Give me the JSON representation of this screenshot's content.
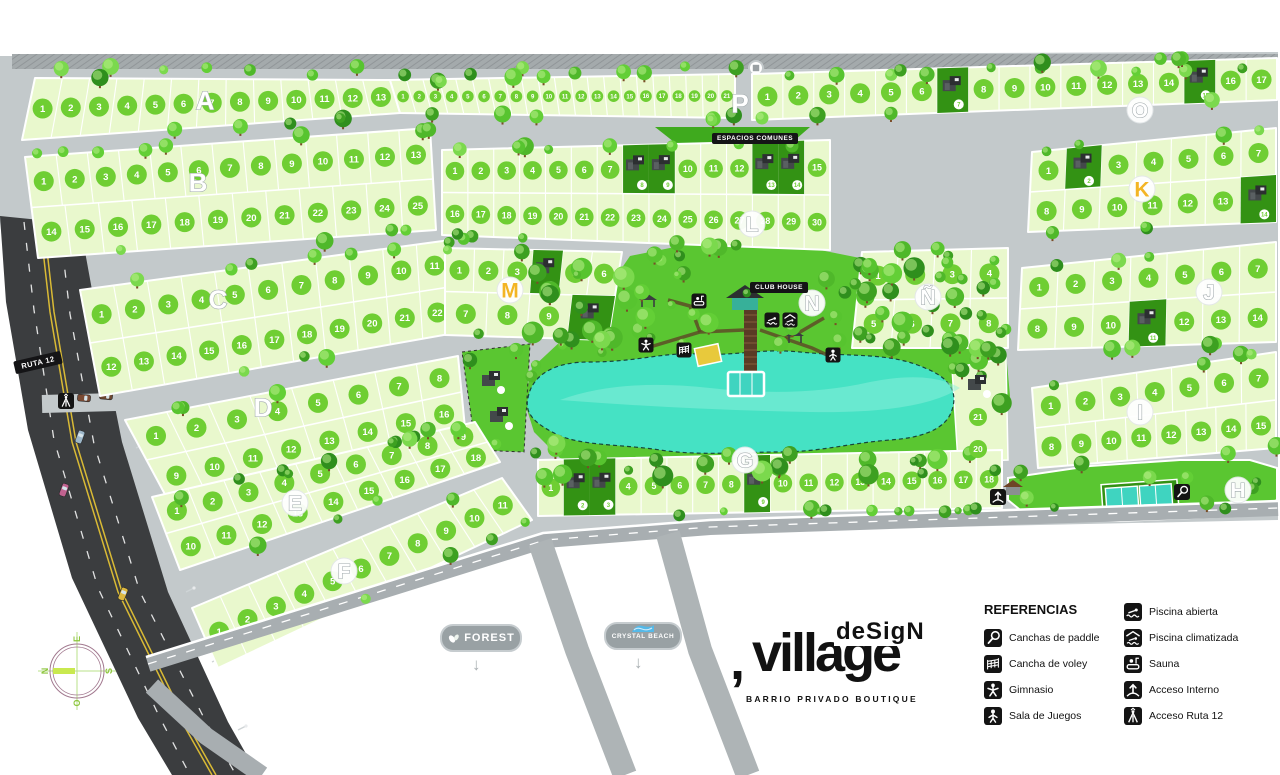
{
  "branding": {
    "logo_comma": ",",
    "logo_main": "village",
    "logo_overlay": "deSigN",
    "logo_subtitle": "BARRIO PRIVADO BOUTIQUE"
  },
  "labels": {
    "club_house": "CLUB HOUSE",
    "espacios_comunes": "ESPACIOS COMUNES",
    "ruta": "RUTA 12"
  },
  "badges": [
    {
      "id": "forest",
      "label": "FOREST",
      "icon": "leaf-icon"
    },
    {
      "id": "crystal-beach",
      "label": "CRYSTAL BEACH",
      "icon": "water-icon"
    }
  ],
  "compass": {
    "north": "N",
    "south": "S",
    "east": "E",
    "west": "O"
  },
  "legend": {
    "title": "REFERENCIAS",
    "columns": [
      [
        {
          "icon": "paddle-icon",
          "label": "Canchas de paddle"
        },
        {
          "icon": "voley-icon",
          "label": "Cancha de voley"
        },
        {
          "icon": "gym-icon",
          "label": "Gimnasio"
        },
        {
          "icon": "games-icon",
          "label": "Sala de Juegos"
        }
      ],
      [
        {
          "icon": "open-pool-icon",
          "label": "Piscina abierta"
        },
        {
          "icon": "heated-pool-icon",
          "label": "Piscina climatizada"
        },
        {
          "icon": "sauna-icon",
          "label": "Sauna"
        },
        {
          "icon": "internal-access-icon",
          "label": "Acceso Interno"
        },
        {
          "icon": "route12-access-icon",
          "label": "Acceso Ruta 12"
        }
      ]
    ]
  },
  "colors": {
    "lot": "#e9f8cd",
    "lot_badge": "#6fce33",
    "badge_text": "#ffffff",
    "model_lot": "#339214",
    "park": "#5ac631",
    "median": "#3faa1e",
    "lake": "#45e2c4",
    "lake_light": "#8ef0db",
    "road_light": "#c3c9cb",
    "road_mid": "#a8aeb1",
    "branch_road": "#aeb4b6",
    "highway": "#3b3d3f",
    "hatch": "#a4aaac",
    "hatch_line": "#84898c",
    "yellow_line": "#d9ba35",
    "letter_yellow": "#f3b525",
    "court": "#3fd4c0",
    "trunk": "#7a4c28",
    "tree_shades": [
      "#4fb82a",
      "#63cf36",
      "#3da021",
      "#7bd94d",
      "#2f8f1d",
      "#57c42f"
    ]
  },
  "map": {
    "blocks": [
      {
        "letter": "A",
        "quad": [
          35,
          78,
          390,
          80,
          400,
          113,
          22,
          140
        ],
        "rows": [
          {
            "from": 1,
            "to": 13
          }
        ],
        "label": [
          205,
          100
        ],
        "circle": false
      },
      {
        "letter": "P",
        "quad": [
          390,
          80,
          735,
          74,
          735,
          118,
          400,
          113
        ],
        "rows": [
          {
            "from": 1,
            "to": 21
          }
        ],
        "label": [
          740,
          103
        ],
        "circle": false
      },
      {
        "letter": "O",
        "quad": [
          752,
          74,
          1277,
          58,
          1277,
          100,
          752,
          120
        ],
        "rows": [
          {
            "from": 1,
            "to": 17
          }
        ],
        "models": [
          7,
          15
        ],
        "label": [
          1140,
          110
        ],
        "circle": true
      },
      {
        "letter": "B",
        "quad": [
          25,
          157,
          430,
          128,
          436,
          230,
          38,
          258
        ],
        "rows": [
          {
            "from": 1,
            "to": 13
          },
          {
            "from": 14,
            "to": 25
          }
        ],
        "label": [
          198,
          182
        ],
        "circle": false
      },
      {
        "letter": "C",
        "quad": [
          80,
          290,
          450,
          240,
          455,
          333,
          100,
          396
        ],
        "rows": [
          {
            "from": 1,
            "to": 11
          },
          {
            "from": 12,
            "to": 22
          }
        ],
        "label": [
          218,
          299
        ],
        "circle": false
      },
      {
        "letter": "D",
        "quad": [
          125,
          420,
          458,
          356,
          465,
          428,
          168,
          500
        ],
        "rows": [
          {
            "from": 1,
            "to": 8
          },
          {
            "from": 9,
            "to": 16
          }
        ],
        "label": [
          263,
          407
        ],
        "circle": false
      },
      {
        "letter": "E",
        "quad": [
          152,
          497,
          475,
          422,
          500,
          462,
          180,
          570
        ],
        "rows": [
          {
            "from": 1,
            "to": 9
          },
          {
            "from": 10,
            "to": 18
          }
        ],
        "label": [
          295,
          503
        ],
        "circle": true
      },
      {
        "letter": "F",
        "quad": [
          192,
          608,
          502,
          478,
          532,
          520,
          218,
          668
        ],
        "rows": [
          {
            "from": 1,
            "to": 11
          }
        ],
        "label": [
          344,
          571
        ],
        "circle": true
      },
      {
        "letter": "G",
        "quad": [
          538,
          460,
          1002,
          450,
          1002,
          508,
          538,
          516
        ],
        "rows": [
          {
            "from": 1,
            "to": 18
          }
        ],
        "models": [
          2,
          3,
          9
        ],
        "label": [
          745,
          460
        ],
        "circle": true
      },
      {
        "letter": "L",
        "quad": [
          442,
          150,
          830,
          140,
          830,
          250,
          442,
          235
        ],
        "rows": [
          {
            "from": 1,
            "to": 15
          },
          {
            "from": 16,
            "to": 30
          }
        ],
        "models": [
          8,
          9,
          13,
          14
        ],
        "label": [
          752,
          224
        ],
        "circle": true
      },
      {
        "letter": "M",
        "quad": [
          445,
          248,
          622,
          252,
          608,
          340,
          445,
          335
        ],
        "rows": [
          {
            "from": 1,
            "to": 6
          },
          {
            "from": 7,
            "to": 10
          }
        ],
        "models": [
          4,
          10
        ],
        "label": [
          510,
          290
        ],
        "circle": true,
        "color": "yellow"
      },
      {
        "letter": "K",
        "quad": [
          1032,
          152,
          1276,
          128,
          1276,
          222,
          1028,
          232
        ],
        "rows": [
          {
            "from": 1,
            "to": 7
          },
          {
            "from": 8,
            "to": 14
          }
        ],
        "models": [
          2,
          14
        ],
        "label": [
          1142,
          189
        ],
        "circle": true,
        "color": "yellow"
      },
      {
        "letter": "J",
        "quad": [
          1022,
          268,
          1276,
          242,
          1276,
          342,
          1018,
          350
        ],
        "rows": [
          {
            "from": 1,
            "to": 7
          },
          {
            "from": 8,
            "to": 14
          }
        ],
        "models": [
          11
        ],
        "label": [
          1209,
          292
        ],
        "circle": true
      },
      {
        "letter": "Ñ",
        "quad": [
          862,
          252,
          1008,
          248,
          1008,
          348,
          852,
          348
        ],
        "rows": [
          {
            "from": 1,
            "to": 4
          },
          {
            "from": 5,
            "to": 8
          }
        ],
        "label": [
          928,
          297
        ],
        "circle": true
      },
      {
        "letter": "I",
        "quad": [
          1032,
          388,
          1276,
          352,
          1276,
          448,
          1038,
          468
        ],
        "rows": [
          {
            "from": 1,
            "to": 7
          },
          {
            "from": 8,
            "to": 15
          }
        ],
        "label": [
          1140,
          412
        ],
        "circle": true
      },
      {
        "letter": "N",
        "label": [
          812,
          303
        ],
        "circle": true
      },
      {
        "letter": "H",
        "label": [
          1238,
          490
        ],
        "circle": true
      }
    ],
    "extra_lots": [
      {
        "n": "21",
        "x": 978,
        "y": 417
      },
      {
        "n": "20",
        "x": 978,
        "y": 449
      }
    ],
    "park_icons": [
      {
        "icon": "sauna-icon",
        "x": 699,
        "y": 301
      },
      {
        "icon": "open-pool-icon",
        "x": 772,
        "y": 320
      },
      {
        "icon": "heated-pool-icon",
        "x": 790,
        "y": 320
      },
      {
        "icon": "gym-icon",
        "x": 646,
        "y": 345
      },
      {
        "icon": "voley-icon",
        "x": 684,
        "y": 350
      },
      {
        "icon": "games-icon",
        "x": 833,
        "y": 355
      }
    ],
    "access_icons": [
      {
        "icon": "route12-access-icon",
        "x": 66,
        "y": 401
      },
      {
        "icon": "internal-access-icon",
        "x": 998,
        "y": 497
      },
      {
        "icon": "paddle-icon",
        "x": 1182,
        "y": 492
      }
    ]
  }
}
